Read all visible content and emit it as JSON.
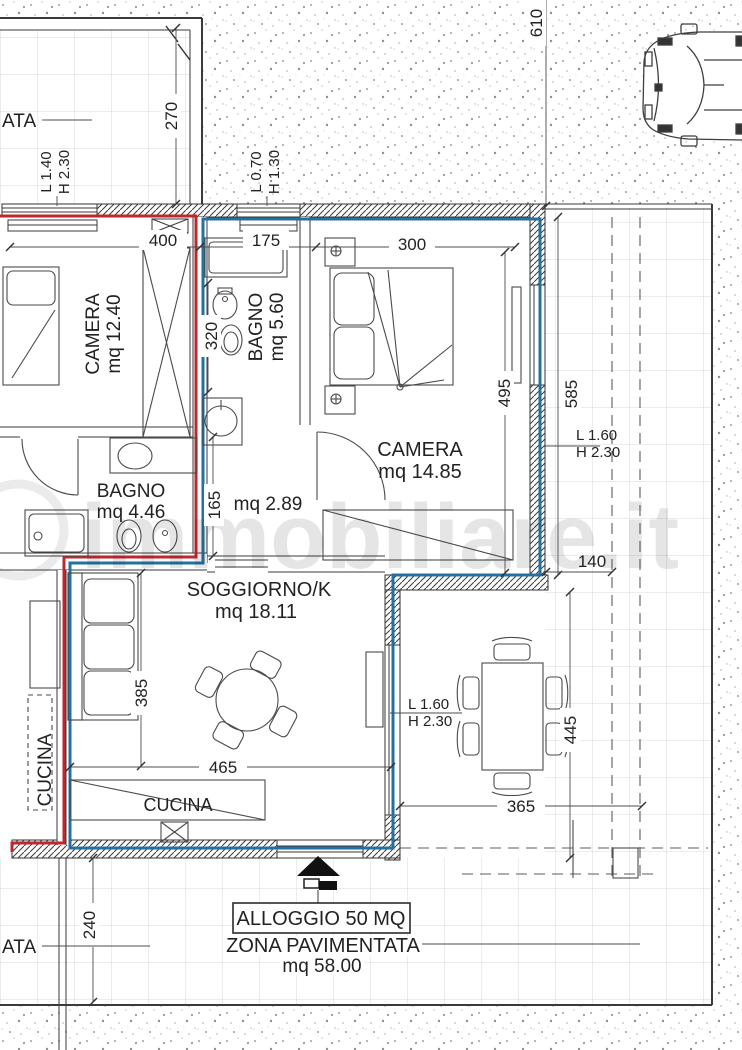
{
  "plan": {
    "watermark": "immobiliare.it",
    "labels": {
      "zona_top_partial": "ATA",
      "zona_bottom_partial": "ATA",
      "alloggio": "ALLOGGIO 50 MQ",
      "zona_pavimentata": "ZONA PAVIMENTATA",
      "zona_pavimentata_mq": "mq 58.00"
    },
    "rooms": {
      "camera1": {
        "name": "CAMERA",
        "area": "mq 12.40"
      },
      "bagno1": {
        "name": "BAGNO",
        "area": "mq 5.60"
      },
      "camera2": {
        "name": "CAMERA",
        "area": "mq 14.85"
      },
      "bagno2": {
        "name": "BAGNO",
        "area": "mq 4.46"
      },
      "disimpegno": {
        "area": "mq 2.89"
      },
      "soggiorno": {
        "name": "SOGGIORNO/K",
        "area": "mq 18.11"
      },
      "cucina_adjacent": {
        "name": "CUCINA"
      },
      "cucina_counter": {
        "name": "CUCINA"
      }
    },
    "dimensions_cm": {
      "d610": "610",
      "d270": "270",
      "d400": "400",
      "d175": "175",
      "d300": "300",
      "d495": "495",
      "d585": "585",
      "d320": "320",
      "d165": "165",
      "d140": "140",
      "d385": "385",
      "d465": "465",
      "d445": "445",
      "d365": "365",
      "d240": "240"
    },
    "windows": {
      "w1": {
        "l": "L 1.40",
        "h": "H 2.30"
      },
      "w2": {
        "l": "L 0.70",
        "h": "H 1.30"
      },
      "w3": {
        "l": "L 1.60",
        "h": "H 2.30"
      },
      "w4": {
        "l": "L 1.60",
        "h": "H 2.30"
      }
    },
    "colors": {
      "unit_outline": "#2470a0",
      "adjacent_outline": "#c0272d"
    }
  }
}
